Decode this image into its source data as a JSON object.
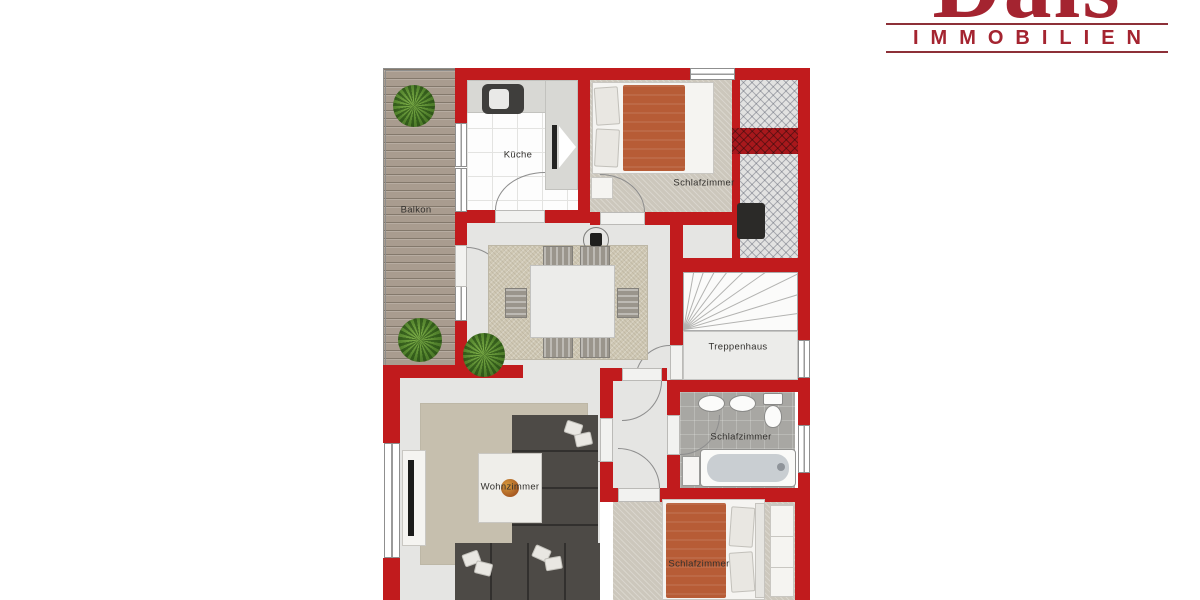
{
  "logo": {
    "brand": "Dais",
    "subtitle": "IMMOBILIEN"
  },
  "rooms": {
    "balcony": "Balkon",
    "kitchen": "Küche",
    "bedroom_top": "Schlafzimmer",
    "staircase": "Treppenhaus",
    "bathroom": "Schlafzimmer",
    "living_room": "Wohnzimmer",
    "bedroom_bottom": "Schlafzimmer"
  },
  "colors": {
    "wall": "#c11b1d",
    "walldark": "#a8181c",
    "logo": "#a42430",
    "logoline": "#8d3038",
    "floor": "#e5e5e3",
    "carpet": "#ccc7bc",
    "rug": "#cfc8b4",
    "wood": "#a99c8f",
    "bath": "#a8a7a3",
    "sofa": "#4d4a46",
    "duvet": "#b75c36"
  }
}
